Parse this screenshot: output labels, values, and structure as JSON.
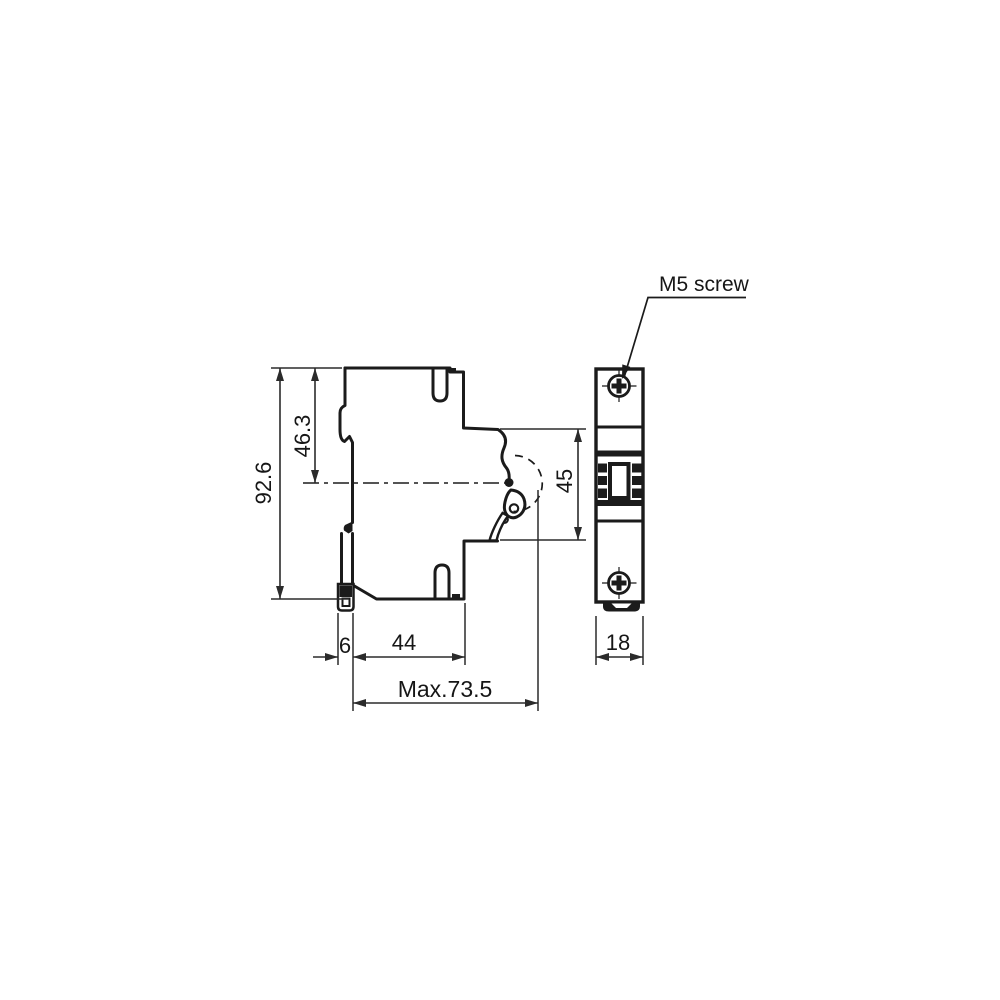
{
  "drawing": {
    "background": "#ffffff",
    "stroke_color": "#1b1b1b",
    "dim_color": "#2b2b2b",
    "labels": {
      "overall_height": "92.6",
      "top_to_center": "46.3",
      "handle_recess_height": "45",
      "clip_protrusion": "6",
      "body_depth": "44",
      "max_depth": "Max.73.5",
      "module_width": "18",
      "screw_note": "M5 screw"
    }
  }
}
